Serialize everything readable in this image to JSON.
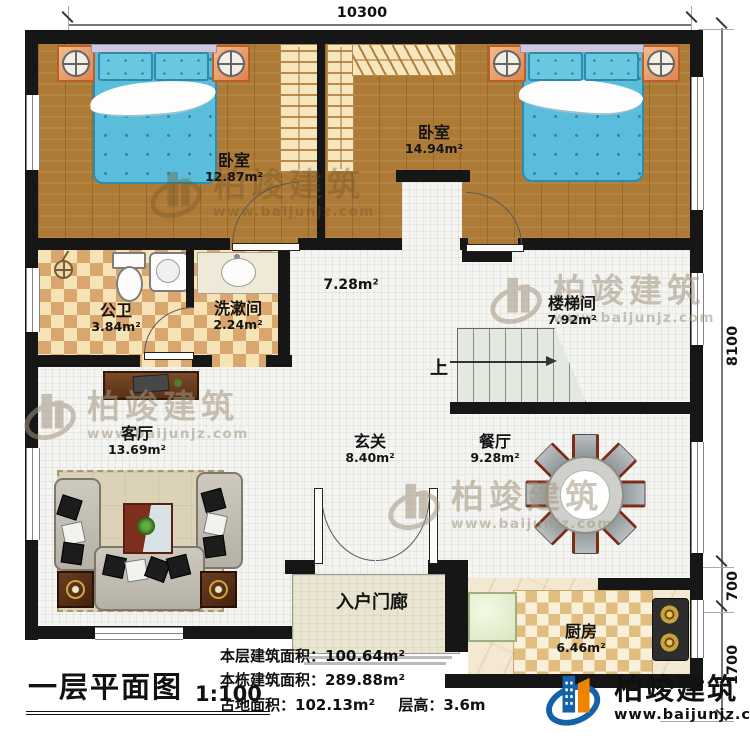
{
  "dims": {
    "top": "10300",
    "right_total": "8100",
    "right_mid": "700",
    "right_bottom": "1700"
  },
  "rooms": {
    "bedroom_left": {
      "name": "卧室",
      "area": "12.87m²"
    },
    "bedroom_right": {
      "name": "卧室",
      "area": "14.94m²"
    },
    "bathroom": {
      "name": "公卫",
      "area": "3.84m²"
    },
    "washroom": {
      "name": "洗漱间",
      "area": "2.24m²"
    },
    "hall": {
      "area": "7.28m²"
    },
    "stairwell": {
      "name": "楼梯间",
      "area": "7.92m²"
    },
    "living": {
      "name": "客厅",
      "area": "13.69m²"
    },
    "foyer": {
      "name": "玄关",
      "area": "8.40m²"
    },
    "dining": {
      "name": "餐厅",
      "area": "9.28m²"
    },
    "porch": {
      "name": "入户门廊"
    },
    "kitchen": {
      "name": "厨房",
      "area": "6.46m²"
    }
  },
  "stairs": {
    "up": "上"
  },
  "title_block": {
    "title": "一层平面图",
    "scale": "1:100"
  },
  "stats": {
    "floor_area_label": "本层建筑面积：",
    "floor_area_value": "100.64m²",
    "total_area_label": "本栋建筑面积：",
    "total_area_value": "289.88m²",
    "land_area_label": "占地面积：",
    "land_area_value": "102.13m²",
    "storey_height_label": "层高：",
    "storey_height_value": "3.6m"
  },
  "branding": {
    "name": "柏竣建筑",
    "website": "www.baijunjz.com"
  },
  "colors": {
    "wall": "#161616",
    "wood": "#ad7b36",
    "tile": "#d9a76d",
    "bed_blue": "#5abddb",
    "logo_blue": "#1461a8",
    "logo_orange": "#f08300"
  }
}
